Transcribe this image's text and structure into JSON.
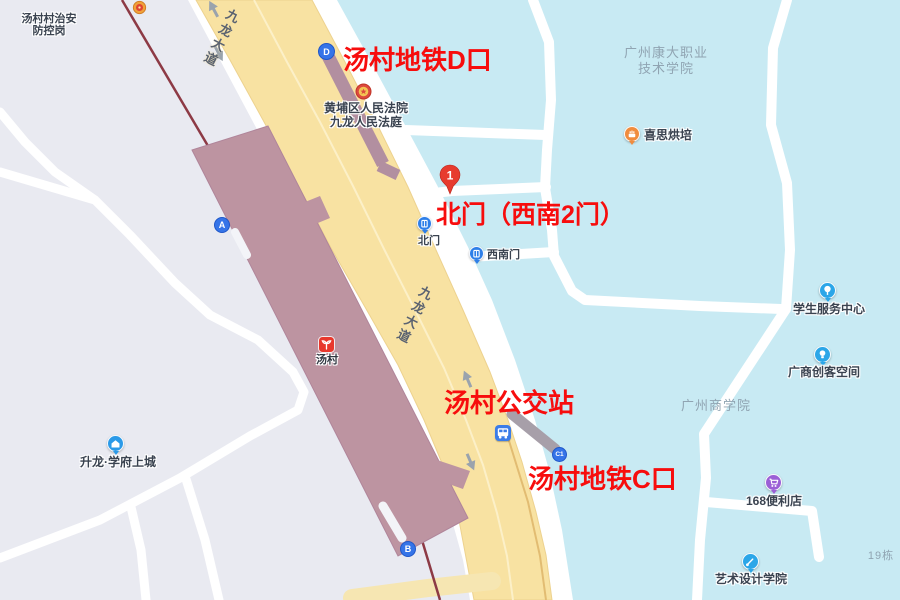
{
  "colors": {
    "annotation_red": "#f70d0d",
    "campus_blue": "#c8eaf3",
    "road_yellow": "#f8e2a2",
    "station_mauve": "#bd94a1",
    "metro_line": "#8d3a45",
    "entrance_blue": "#3574e8",
    "poi_blue": "#2ba6e8"
  },
  "road": {
    "name": "九龙大道"
  },
  "annotations": {
    "d_exit": "汤村地铁D口",
    "north_gate": "北门（西南2门）",
    "bus_station": "汤村公交站",
    "c_exit": "汤村地铁C口"
  },
  "marker": {
    "label": "1"
  },
  "station": {
    "name": "汤村",
    "entrance_a": "A",
    "entrance_b": "B",
    "entrance_d": "D",
    "entrance_c1": "C1"
  },
  "gates": {
    "north": "北门",
    "southwest": "西南门"
  },
  "pois": {
    "security_post": {
      "line1": "汤村村治安",
      "line2": "防控岗"
    },
    "court": {
      "line1": "黄埔区人民法院",
      "line2": "九龙人民法庭"
    },
    "bakery": {
      "label": "喜思烘培"
    },
    "student_center": {
      "label": "学生服务中心"
    },
    "maker_space": {
      "label": "广商创客空间"
    },
    "store_168": {
      "label": "168便利店"
    },
    "art_school": {
      "label": "艺术设计学院"
    },
    "residence": {
      "label": "升龙·学府上城"
    }
  },
  "areas": {
    "kangda_college": {
      "line1": "广州康大职业",
      "line2": "技术学院"
    },
    "business_college": {
      "label": "广州商学院"
    },
    "building_19": {
      "label": "19栋"
    }
  }
}
